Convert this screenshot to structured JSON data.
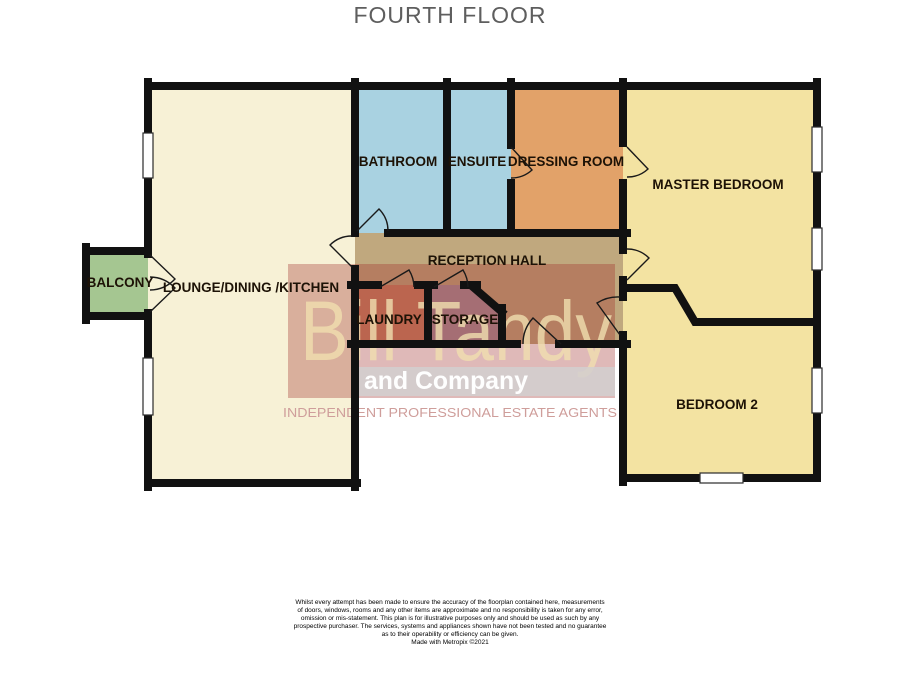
{
  "title": "FOURTH FLOOR",
  "floorplan": {
    "wall_color": "#111111",
    "label_color": "#1d1206",
    "rooms": {
      "lounge": {
        "label": "LOUNGE/DINING /KITCHEN",
        "color": "#f7f1d6"
      },
      "bathroom": {
        "label": "BATHROOM",
        "color": "#a9d2e1"
      },
      "ensuite": {
        "label": "ENSUITE",
        "color": "#a9d2e1"
      },
      "dressing": {
        "label": "DRESSING ROOM",
        "color": "#e2a269"
      },
      "master": {
        "label": "MASTER BEDROOM",
        "color": "#f3e3a2"
      },
      "bedroom2": {
        "label": "BEDROOM 2",
        "color": "#f3e3a2"
      },
      "hall": {
        "label": "RECEPTION HALL",
        "color": "#c0a87e"
      },
      "laundry": {
        "label": "LAUNDRY",
        "color": "#c98263"
      },
      "storage": {
        "label": "STORAGE",
        "color": "#a9909a"
      },
      "balcony": {
        "label": "BALCONY",
        "color": "#a5c691"
      }
    }
  },
  "watermark": {
    "name": "Bill Tandy",
    "subname": "and Company",
    "tagline": "INDEPENDENT PROFESSIONAL ESTATE AGENTS",
    "box_color": "rgba(158,44,38,0.33)",
    "name_color": "rgba(240,222,175,0.8)",
    "band_color": "rgba(210,207,207,0.85)",
    "subname_color": "#fefefe",
    "tagline_color": "#cf9e9b"
  },
  "footer": {
    "disclaimer_lines": [
      "Whilst every attempt has been made to ensure the accuracy of the floorplan contained here, measurements",
      "of doors, windows, rooms and any other items are approximate and no responsibility is taken for any error,",
      "omission or mis-statement. This plan is for illustrative purposes only and should be used as such by any",
      "prospective purchaser. The services, systems and appliances shown have not been tested and no guarantee",
      "as to their operability or efficiency can be given."
    ],
    "credit": "Made with Metropix ©2021"
  }
}
